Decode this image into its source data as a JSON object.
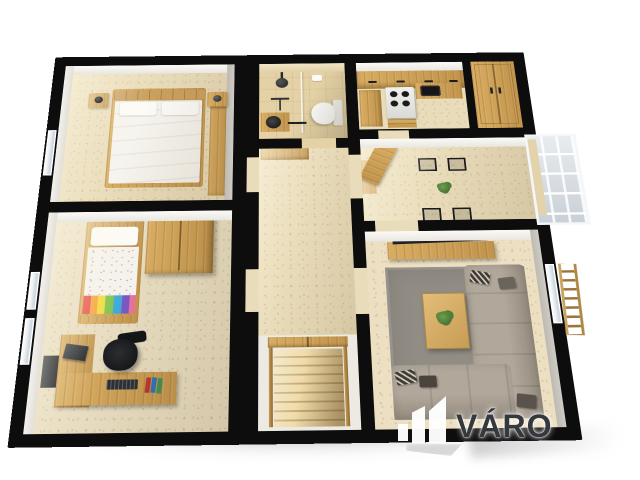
{
  "watermark": {
    "text": "VÁRO",
    "logo_icon": "city-buildings-logo-icon"
  },
  "palette": {
    "bg": "#ffffff",
    "wall": "#0d0d0d",
    "floor": "#e9dcba",
    "wood": "#d8ac61",
    "wood_dark": "#c1944c",
    "sofa": "#a89f93",
    "rug": "#918d85",
    "gray_wall": "#b2b8be",
    "watermark_text": "#35383d"
  },
  "scene": {
    "type": "3d-rendered apartment floor plan, top-down perspective, thick black walls, white background",
    "rooms": [
      {
        "name": "bedroom",
        "position": "top-left",
        "contents": [
          "double bed with white duvet",
          "wood headboard",
          "two nightstands with black lamps",
          "wardrobe on right wall",
          "window on left wall"
        ]
      },
      {
        "name": "bathroom",
        "position": "top-center",
        "contents": [
          "beige tiles",
          "walk-in shower with black fixtures",
          "glass partition",
          "white toilet",
          "black round sink",
          "toilet-paper holder"
        ]
      },
      {
        "name": "kitchen",
        "position": "top-right",
        "contents": [
          "wood cabinets",
          "white stove with four black burners",
          "black sink",
          "drawer unit"
        ]
      },
      {
        "name": "pantry-closet",
        "position": "top-far-right",
        "contents": [
          "full-height wood wardrobe"
        ]
      },
      {
        "name": "hallway",
        "position": "center",
        "contents": [
          "travertine beige floor",
          "built-in wood cabinet"
        ]
      },
      {
        "name": "dining-room",
        "position": "center-right",
        "contents": [
          "wood dining table",
          "four black chairs",
          "potted plant",
          "open wood door",
          "gray accent wall with window"
        ]
      },
      {
        "name": "balcony",
        "position": "right-exterior",
        "contents": [
          "glazed white enclosure"
        ]
      },
      {
        "name": "kids-room-study",
        "position": "bottom-left",
        "contents": [
          "single bed with colorful striped duvet",
          "wood wardrobe",
          "L-shaped desk",
          "monitor",
          "pc tower",
          "keyboard",
          "books",
          "black office chair",
          "window on left wall"
        ]
      },
      {
        "name": "staircase",
        "position": "bottom-center",
        "contents": [
          "wood steps descending",
          "wood handrails",
          "double doors at top"
        ]
      },
      {
        "name": "living-room",
        "position": "bottom-right",
        "contents": [
          "L-shaped taupe sectional sofa",
          "patterned cushions",
          "wood coffee table with plant",
          "flat tv on wood media console",
          "gray rug",
          "window on right wall",
          "wood ladder rack outside wall"
        ]
      }
    ]
  }
}
